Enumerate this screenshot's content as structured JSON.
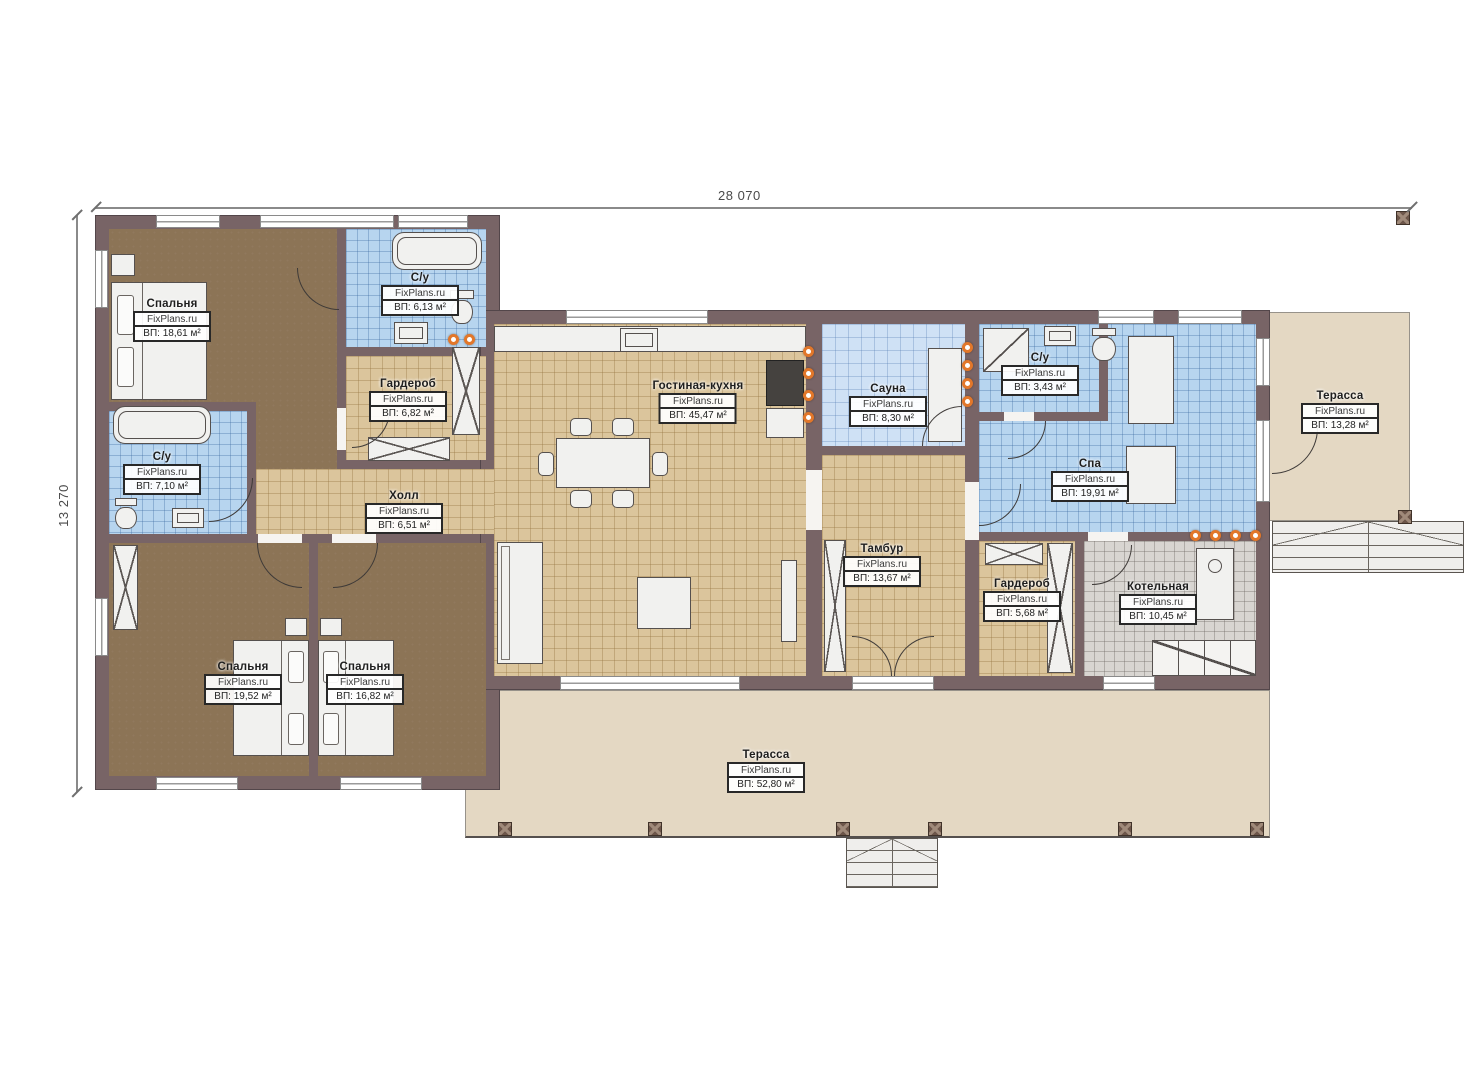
{
  "dimensions": {
    "top": "28 070",
    "left": "13 270"
  },
  "watermark": "FixPlans.ru",
  "rooms": [
    {
      "name": "Спальня",
      "area": "ВП: 18,61 м²"
    },
    {
      "name": "С/у",
      "area": "ВП: 6,13 м²"
    },
    {
      "name": "Гардероб",
      "area": "ВП: 6,82 м²"
    },
    {
      "name": "С/у",
      "area": "ВП: 7,10 м²"
    },
    {
      "name": "Холл",
      "area": "ВП: 6,51 м²"
    },
    {
      "name": "Гостиная-кухня",
      "area": "ВП: 45,47 м²"
    },
    {
      "name": "Сауна",
      "area": "ВП: 8,30 м²"
    },
    {
      "name": "С/у",
      "area": "ВП: 3,43 м²"
    },
    {
      "name": "Спа",
      "area": "ВП: 19,91 м²"
    },
    {
      "name": "Терасса",
      "area": "ВП: 13,28 м²"
    },
    {
      "name": "Тамбур",
      "area": "ВП: 13,67 м²"
    },
    {
      "name": "Гардероб",
      "area": "ВП: 5,68 м²"
    },
    {
      "name": "Котельная",
      "area": "ВП: 10,45 м²"
    },
    {
      "name": "Спальня",
      "area": "ВП: 19,52 м²"
    },
    {
      "name": "Спальня",
      "area": "ВП: 16,82 м²"
    },
    {
      "name": "Терасса",
      "area": "ВП: 52,80 м²"
    }
  ],
  "colors": {
    "wall": "#786466",
    "floor_wood": "#8c7456",
    "tile_tan": "#dbc59c",
    "tile_blue": "#b7d5ef",
    "tile_blue_light": "#cfe1f5",
    "tile_gray": "#d8d5d1",
    "terrace": "#e4d8c3",
    "downlight": "#e2772a"
  }
}
